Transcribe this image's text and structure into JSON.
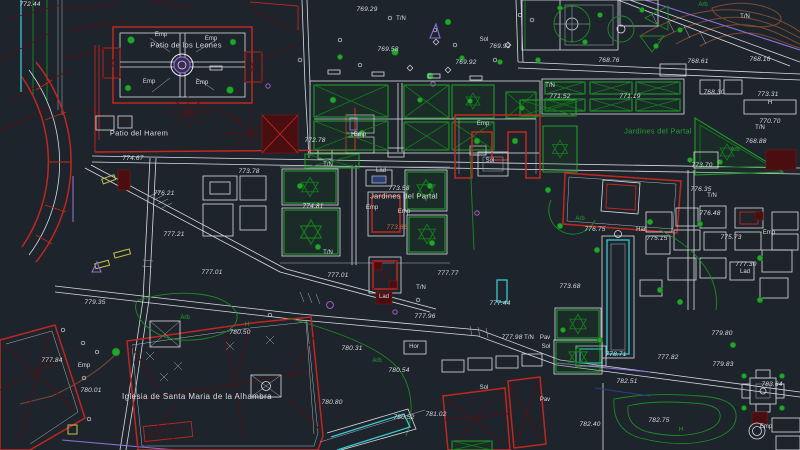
{
  "canvas": {
    "type": "cad-site-plan",
    "subject": "Alhambra survey drawing",
    "width": 800,
    "height": 450
  },
  "palette": {
    "background": "#1d242c",
    "line_white": "#d9dde2",
    "line_gray": "#8a9097",
    "red": "#c1271f",
    "dark_red": "#541114",
    "green": "#23a42a",
    "dark_green": "#157a1e",
    "cyan": "#3bc6cf",
    "violet": "#8e6fd8",
    "brown": "#7d4a31",
    "yellow": "#c8bf47",
    "magenta": "#b75fd0",
    "text": "#d9dde2"
  },
  "map": {
    "places": [
      {
        "text": "Patio de los Leones",
        "x": 186,
        "y": 45,
        "color": "text",
        "cls": "place"
      },
      {
        "text": "Patio del Harem",
        "x": 139,
        "y": 133,
        "color": "text",
        "cls": "place"
      },
      {
        "text": "Jardines del Partal",
        "x": 404,
        "y": 196,
        "color": "text",
        "cls": "place"
      },
      {
        "text": "Jardines del Partal",
        "x": 658,
        "y": 131,
        "color": "green",
        "cls": "place"
      },
      {
        "text": "Iglesia de Santa Maria de la Alhambra",
        "x": 197,
        "y": 397,
        "color": "text",
        "cls": "place-lg"
      }
    ],
    "elevations": [
      {
        "text": "772.44",
        "x": 30,
        "y": 5
      },
      {
        "text": "769.29",
        "x": 367,
        "y": 10
      },
      {
        "text": "769.58",
        "x": 388,
        "y": 50
      },
      {
        "text": "769.92",
        "x": 500,
        "y": 47
      },
      {
        "text": "769.92",
        "x": 466,
        "y": 63
      },
      {
        "text": "768.76",
        "x": 609,
        "y": 61
      },
      {
        "text": "768.61",
        "x": 698,
        "y": 62
      },
      {
        "text": "768.16",
        "x": 760,
        "y": 60
      },
      {
        "text": "771.52",
        "x": 560,
        "y": 97
      },
      {
        "text": "771.19",
        "x": 630,
        "y": 97
      },
      {
        "text": "768.30",
        "x": 714,
        "y": 93
      },
      {
        "text": "773.31",
        "x": 768,
        "y": 95
      },
      {
        "text": "770.70",
        "x": 770,
        "y": 122
      },
      {
        "text": "768.88",
        "x": 756,
        "y": 142
      },
      {
        "text": "772.78",
        "x": 315,
        "y": 141
      },
      {
        "text": "774.67",
        "x": 133,
        "y": 159
      },
      {
        "text": "773.78",
        "x": 249,
        "y": 172
      },
      {
        "text": "776.21",
        "x": 164,
        "y": 194
      },
      {
        "text": "774.81",
        "x": 313,
        "y": 207
      },
      {
        "text": "773.58",
        "x": 399,
        "y": 189
      },
      {
        "text": "773.66",
        "x": 397,
        "y": 228,
        "color": "salmon"
      },
      {
        "text": "777.21",
        "x": 174,
        "y": 235
      },
      {
        "text": "777.01",
        "x": 212,
        "y": 273
      },
      {
        "text": "777.01",
        "x": 338,
        "y": 276
      },
      {
        "text": "777.77",
        "x": 448,
        "y": 274
      },
      {
        "text": "776.75",
        "x": 595,
        "y": 230
      },
      {
        "text": "775.15",
        "x": 657,
        "y": 239
      },
      {
        "text": "776.35",
        "x": 701,
        "y": 190
      },
      {
        "text": "776.48",
        "x": 710,
        "y": 214
      },
      {
        "text": "775.73",
        "x": 731,
        "y": 238
      },
      {
        "text": "777.30",
        "x": 746,
        "y": 265
      },
      {
        "text": "773.68",
        "x": 570,
        "y": 287
      },
      {
        "text": "773.70",
        "x": 702,
        "y": 166
      },
      {
        "text": "779.35",
        "x": 95,
        "y": 303
      },
      {
        "text": "777.84",
        "x": 52,
        "y": 361
      },
      {
        "text": "780.01",
        "x": 91,
        "y": 391
      },
      {
        "text": "780.50",
        "x": 240,
        "y": 333
      },
      {
        "text": "780.31",
        "x": 352,
        "y": 349
      },
      {
        "text": "780.54",
        "x": 399,
        "y": 371
      },
      {
        "text": "777.96",
        "x": 425,
        "y": 317
      },
      {
        "text": "780.80",
        "x": 332,
        "y": 403
      },
      {
        "text": "780.52",
        "x": 404,
        "y": 418
      },
      {
        "text": "781.02",
        "x": 436,
        "y": 415
      },
      {
        "text": "777.44",
        "x": 500,
        "y": 304
      },
      {
        "text": "777.98",
        "x": 512,
        "y": 338
      },
      {
        "text": "778.71",
        "x": 616,
        "y": 355
      },
      {
        "text": "782.51",
        "x": 627,
        "y": 382
      },
      {
        "text": "777.82",
        "x": 668,
        "y": 358
      },
      {
        "text": "779.83",
        "x": 723,
        "y": 365
      },
      {
        "text": "779.80",
        "x": 722,
        "y": 334
      },
      {
        "text": "782.75",
        "x": 659,
        "y": 421
      },
      {
        "text": "782.40",
        "x": 590,
        "y": 425
      },
      {
        "text": "783.64",
        "x": 772,
        "y": 385
      }
    ],
    "tags": [
      {
        "text": "Emp",
        "x": 161,
        "y": 35
      },
      {
        "text": "Emp",
        "x": 211,
        "y": 39
      },
      {
        "text": "Emp",
        "x": 149,
        "y": 82
      },
      {
        "text": "Emp",
        "x": 202,
        "y": 83
      },
      {
        "text": "Emp",
        "x": 360,
        "y": 135
      },
      {
        "text": "Emp",
        "x": 483,
        "y": 124
      },
      {
        "text": "Emp",
        "x": 372,
        "y": 208
      },
      {
        "text": "Emp",
        "x": 404,
        "y": 212
      },
      {
        "text": "Emp",
        "x": 84,
        "y": 366
      },
      {
        "text": "Emp",
        "x": 769,
        "y": 233
      },
      {
        "text": "Emp",
        "x": 766,
        "y": 427
      },
      {
        "text": "Har",
        "x": 356,
        "y": 135
      },
      {
        "text": "Har",
        "x": 641,
        "y": 230
      },
      {
        "text": "Hor",
        "x": 414,
        "y": 347
      },
      {
        "text": "Sol",
        "x": 484,
        "y": 40
      },
      {
        "text": "Sol",
        "x": 490,
        "y": 161
      },
      {
        "text": "Sol",
        "x": 484,
        "y": 388
      },
      {
        "text": "Sol",
        "x": 546,
        "y": 347
      },
      {
        "text": "Lad",
        "x": 381,
        "y": 171
      },
      {
        "text": "Lad",
        "x": 745,
        "y": 272
      },
      {
        "text": "Lad",
        "x": 384,
        "y": 297
      },
      {
        "text": "T/N",
        "x": 401,
        "y": 19
      },
      {
        "text": "T/N",
        "x": 550,
        "y": 86
      },
      {
        "text": "T/N",
        "x": 328,
        "y": 165
      },
      {
        "text": "T/N",
        "x": 328,
        "y": 253
      },
      {
        "text": "T/N",
        "x": 421,
        "y": 288
      },
      {
        "text": "T/N",
        "x": 712,
        "y": 196
      },
      {
        "text": "T/N",
        "x": 760,
        "y": 128
      },
      {
        "text": "T/N",
        "x": 529,
        "y": 338
      },
      {
        "text": "T/N",
        "x": 745,
        "y": 17
      },
      {
        "text": "Pav",
        "x": 545,
        "y": 338
      },
      {
        "text": "Pav",
        "x": 545,
        "y": 400
      },
      {
        "text": "Arb",
        "x": 185,
        "y": 318,
        "color": "green"
      },
      {
        "text": "Arb",
        "x": 377,
        "y": 361,
        "color": "green"
      },
      {
        "text": "Arb",
        "x": 580,
        "y": 219,
        "color": "green"
      },
      {
        "text": "Arb",
        "x": 735,
        "y": 150,
        "color": "green"
      },
      {
        "text": "Arb",
        "x": 703,
        "y": 5,
        "color": "green"
      },
      {
        "text": "H",
        "x": 770,
        "y": 103
      },
      {
        "text": "H",
        "x": 247,
        "y": 325,
        "color": "green"
      },
      {
        "text": "H",
        "x": 681,
        "y": 430,
        "color": "green"
      }
    ]
  }
}
